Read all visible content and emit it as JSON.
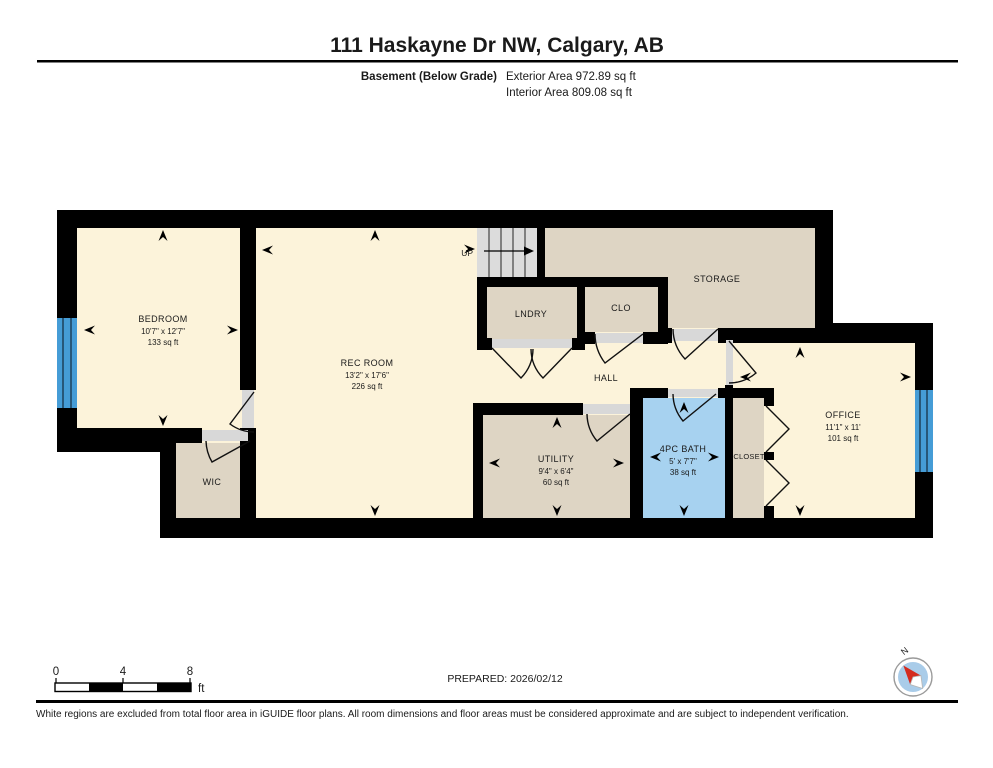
{
  "header": {
    "title": "111 Haskayne Dr NW, Calgary, AB",
    "floor_label": "Basement (Below Grade)",
    "exterior_area": "Exterior Area 972.89 sq ft",
    "interior_area": "Interior Area 809.08 sq ft"
  },
  "rooms": {
    "bedroom": {
      "name": "BEDROOM",
      "dims": "10'7\" x 12'7\"",
      "area": "133 sq ft"
    },
    "rec_room": {
      "name": "REC ROOM",
      "dims": "13'2\" x 17'6\"",
      "area": "226 sq ft"
    },
    "laundry": {
      "name": "LNDRY"
    },
    "clo": {
      "name": "CLO"
    },
    "storage": {
      "name": "STORAGE"
    },
    "hall": {
      "name": "HALL"
    },
    "wic": {
      "name": "WIC"
    },
    "utility": {
      "name": "UTILITY",
      "dims": "9'4\" x 6'4\"",
      "area": "60 sq ft"
    },
    "bath": {
      "name": "4PC BATH",
      "dims": "5' x 7'7\"",
      "area": "38 sq ft"
    },
    "closet": {
      "name": "CLOSET"
    },
    "office": {
      "name": "OFFICE",
      "dims": "11'1\" x 11'",
      "area": "101 sq ft"
    }
  },
  "stairs": {
    "label": "UP"
  },
  "scale_bar": {
    "ticks": [
      "0",
      "4",
      "8"
    ],
    "unit": "ft"
  },
  "compass": {
    "label": "N"
  },
  "footer": {
    "prepared": "PREPARED: 2026/02/12",
    "disclaimer": "White regions are excluded from total floor area in iGUIDE floor plans. All room dimensions and floor areas must be considered approximate and are subject to independent verification."
  },
  "colors": {
    "wall": "#000000",
    "cream": "#FCF3DA",
    "tan": "#DED5C4",
    "bath": "#A7D2F0",
    "window": "#459CD6",
    "stairs": "#DCDCDC",
    "threshold": "#D8D8D8",
    "compass": "#A9CCE9",
    "needle": "#D42B1E"
  }
}
